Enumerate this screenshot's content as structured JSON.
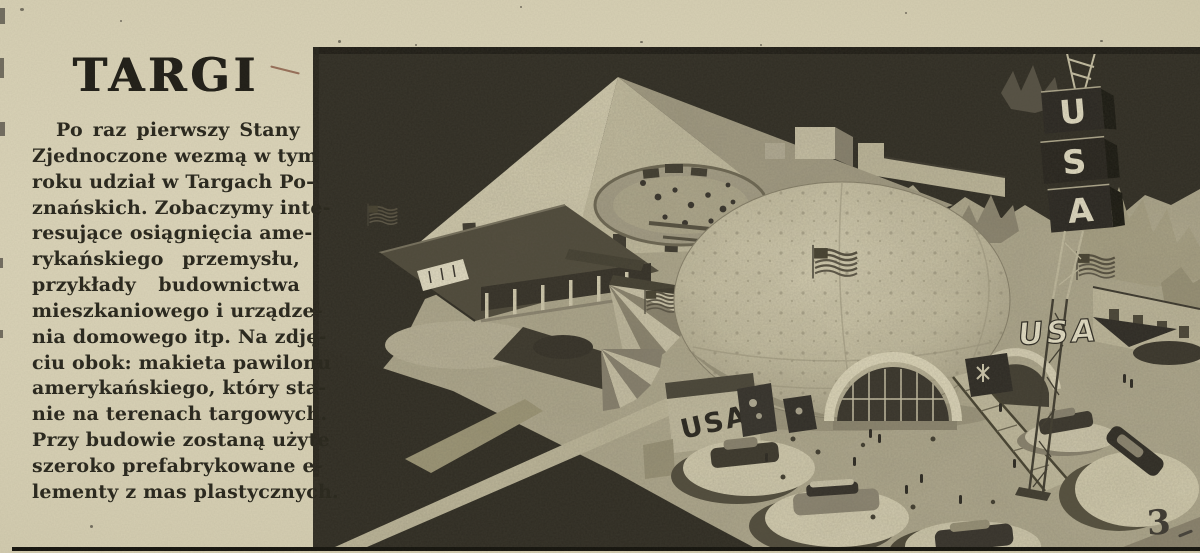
{
  "page": {
    "page_number": "3",
    "colors": {
      "paper": "#d7d0b4",
      "ink": "#29271d",
      "photo_light": "#c6bfa2",
      "photo_dark": "#2e2b22"
    }
  },
  "article": {
    "headline": "TARGI",
    "lines": [
      "Po raz pierwszy Stany",
      "Zjednoczone wezmą w tym",
      "roku udział w Targach Po-",
      "znańskich. Zobaczymy inte-",
      "resujące osiągnięcia ame-",
      "rykańskiego przemysłu,",
      "przykłady budownictwa",
      "mieszkaniowego i urządze-",
      "nia domowego itp. Na zdję-",
      "ciu obok: makieta pawilonu",
      "amerykańskiego, który sta-",
      "nie na terenach targowych.",
      "Przy budowie zostaną użyte",
      "szeroko prefabrykowane e-",
      "lementy z mas plastycznych."
    ]
  },
  "photo": {
    "tower_letters": [
      "U",
      "S",
      "A"
    ],
    "rooftop_sign": "USA",
    "wall_sign": "USA"
  }
}
